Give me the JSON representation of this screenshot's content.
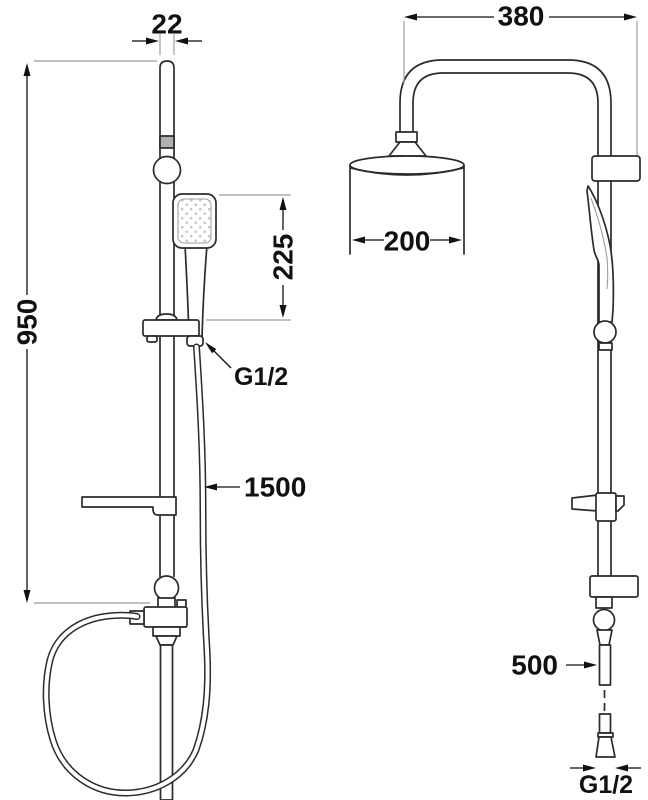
{
  "dims": {
    "rail_width": "22",
    "column_height": "950",
    "handshower_length": "225",
    "handshower_connection_thread": "G1/2",
    "hose_length": "1500",
    "arm_projection": "380",
    "head_diameter": "200",
    "connector_length": "500",
    "inlet_thread": "G1/2"
  },
  "colors": {
    "line": "#2b2b2b",
    "dim": "#111111",
    "ext": "#9e9e9e",
    "band": "#b0b0b0",
    "dots": "#c6c6c6",
    "bg": "#ffffff"
  }
}
